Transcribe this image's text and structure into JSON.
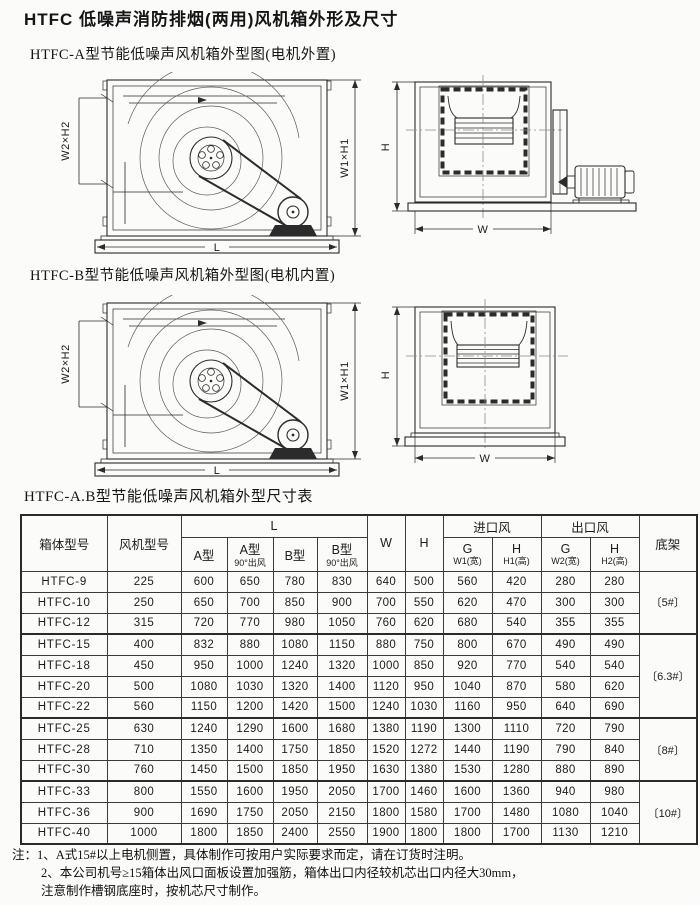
{
  "page": {
    "title": "HTFC 低噪声消防排烟(两用)风机箱外形及尺寸",
    "caption_a": "HTFC-A型节能低噪声风机箱外型图(电机外置)",
    "caption_b": "HTFC-B型节能低噪声风机箱外型图(电机内置)",
    "table_title": "HTFC-A.B型节能低噪声风机箱外型尺寸表"
  },
  "dims": {
    "w2h2": "W2×H2",
    "w1h1": "W1×H1",
    "l": "L",
    "h": "H",
    "w": "W"
  },
  "table": {
    "header": {
      "box_model": "箱体型号",
      "fan_model": "风机型号",
      "l_group": "L",
      "a": "A型",
      "a90_1": "A型",
      "a90_2": "90°出风",
      "b": "B型",
      "b90_1": "B型",
      "b90_2": "90°出风",
      "w": "W",
      "h": "H",
      "inlet": "进口风",
      "inlet_g1": "G",
      "inlet_g2": "W1(宽)",
      "inlet_h1": "H",
      "inlet_h2": "H1(高)",
      "outlet": "出口风",
      "outlet_g1": "G",
      "outlet_g2": "W2(宽)",
      "outlet_h1": "H",
      "outlet_h2": "H2(高)",
      "frame": "底架"
    },
    "rows": [
      [
        "HTFC-9",
        "225",
        "600",
        "650",
        "780",
        "830",
        "640",
        "500",
        "560",
        "420",
        "280",
        "280"
      ],
      [
        "HTFC-10",
        "250",
        "650",
        "700",
        "850",
        "900",
        "700",
        "550",
        "620",
        "470",
        "300",
        "300"
      ],
      [
        "HTFC-12",
        "315",
        "720",
        "770",
        "980",
        "1050",
        "760",
        "620",
        "680",
        "540",
        "355",
        "355"
      ],
      [
        "HTFC-15",
        "400",
        "832",
        "880",
        "1080",
        "1150",
        "880",
        "750",
        "800",
        "670",
        "490",
        "490"
      ],
      [
        "HTFC-18",
        "450",
        "950",
        "1000",
        "1240",
        "1320",
        "1000",
        "850",
        "920",
        "770",
        "540",
        "540"
      ],
      [
        "HTFC-20",
        "500",
        "1080",
        "1030",
        "1320",
        "1400",
        "1120",
        "950",
        "1040",
        "870",
        "580",
        "620"
      ],
      [
        "HTFC-22",
        "560",
        "1150",
        "1200",
        "1420",
        "1500",
        "1240",
        "1030",
        "1160",
        "950",
        "640",
        "690"
      ],
      [
        "HTFC-25",
        "630",
        "1240",
        "1290",
        "1600",
        "1680",
        "1380",
        "1190",
        "1300",
        "1110",
        "720",
        "790"
      ],
      [
        "HTFC-28",
        "710",
        "1350",
        "1400",
        "1750",
        "1850",
        "1520",
        "1272",
        "1440",
        "1190",
        "790",
        "840"
      ],
      [
        "HTFC-30",
        "760",
        "1450",
        "1500",
        "1850",
        "1950",
        "1630",
        "1380",
        "1530",
        "1280",
        "880",
        "890"
      ],
      [
        "HTFC-33",
        "800",
        "1550",
        "1600",
        "1950",
        "2050",
        "1700",
        "1460",
        "1600",
        "1360",
        "940",
        "980"
      ],
      [
        "HTFC-36",
        "900",
        "1690",
        "1750",
        "2050",
        "2150",
        "1800",
        "1580",
        "1700",
        "1480",
        "1080",
        "1040"
      ],
      [
        "HTFC-40",
        "1000",
        "1800",
        "1850",
        "2400",
        "2550",
        "1900",
        "1800",
        "1800",
        "1700",
        "1130",
        "1210"
      ]
    ],
    "frames": [
      {
        "label": "〔5#〕",
        "rows": 3
      },
      {
        "label": "〔6.3#〕",
        "rows": 4
      },
      {
        "label": "〔8#〕",
        "rows": 3
      },
      {
        "label": "〔10#〕",
        "rows": 3
      }
    ]
  },
  "notes": [
    "注：1、A式15#以上电机侧置，具体制作可按用户实际要求而定，请在订货时注明。",
    "2、本公司机号≥15箱体出风口面板设置加强筋，箱体出口内径较机芯出口内径大30mm，",
    "注意制作槽钢底座时，按机芯尺寸制作。"
  ]
}
